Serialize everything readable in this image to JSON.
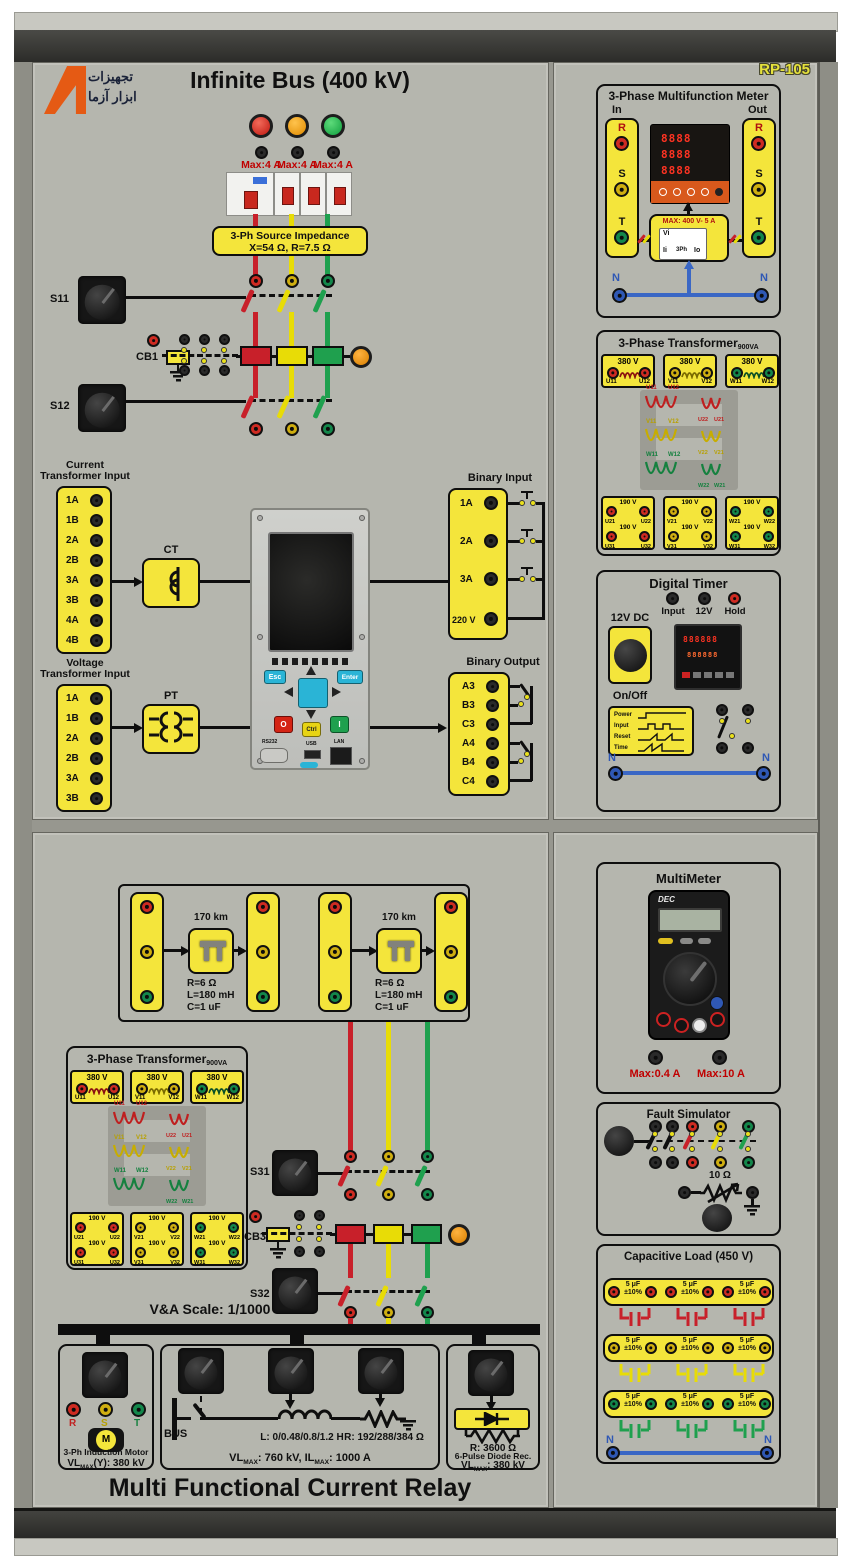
{
  "palette": {
    "panel": "#b5b6ae",
    "yellow": "#f4e53b",
    "phase_red": "#c8202a",
    "phase_yellow": "#e8dc06",
    "phase_green": "#1fa04e",
    "neutral_blue": "#3a67c5",
    "label_red": "#c00000",
    "amber": "#e08b00"
  },
  "brand": {
    "model": "RP-105",
    "logo1": "تجهیزات",
    "logo2": "ابزار آزما"
  },
  "infinite_bus": {
    "title": "Infinite Bus (400 kV)",
    "max_fuse": "Max:4 A",
    "imp1": "3-Ph Source Impedance",
    "imp2": "X=54 Ω, R=7.5 Ω",
    "s11": "S11",
    "cb1": "CB1",
    "s12": "S12"
  },
  "relay_io": {
    "ct_t1": "Current",
    "ct_t2": "Transformer Input",
    "ct_terms": [
      "1A",
      "1B",
      "2A",
      "2B",
      "3A",
      "3B",
      "4A",
      "4B"
    ],
    "ct": "CT",
    "vt_t1": "Voltage",
    "vt_t2": "Transformer Input",
    "vt_terms": [
      "1A",
      "1B",
      "2A",
      "2B",
      "3A",
      "3B"
    ],
    "pt": "PT",
    "bi_title": "Binary Input",
    "bi_terms": [
      "1A",
      "2A",
      "3A",
      "220 V"
    ],
    "bo_title": "Binary Output",
    "bo_terms": [
      "A3",
      "B3",
      "C3",
      "A4",
      "B4",
      "C4"
    ]
  },
  "relay": {
    "esc": "Esc",
    "enter": "Enter",
    "off": "O",
    "ctrl": "Ctrl",
    "on": "I",
    "rs232": "RS232",
    "usb": "USB",
    "lan": "LAN"
  },
  "meter": {
    "title": "3-Phase Multifunction Meter",
    "in": "In",
    "out": "Out",
    "r": "R",
    "s": "S",
    "t": "T",
    "n": "N",
    "display": [
      "8888",
      "8888",
      "8888"
    ],
    "max": "MAX: 400 V- 5 A",
    "vi": "Vi",
    "ii": "Ii",
    "ph": "3Ph",
    "io": "Io"
  },
  "xfmr": {
    "title": "3-Phase Transformer",
    "sub": "900VA",
    "hv_v": "380 V",
    "lv_v": "190 V",
    "hv": [
      [
        "U11",
        "U12"
      ],
      [
        "V11",
        "V12"
      ],
      [
        "W11",
        "W12"
      ]
    ],
    "lv1": [
      [
        "U21",
        "U22"
      ],
      [
        "V21",
        "V22"
      ],
      [
        "W21",
        "W22"
      ]
    ],
    "lv2": [
      [
        "U31",
        "U32"
      ],
      [
        "V31",
        "V32"
      ],
      [
        "W31",
        "W32"
      ]
    ],
    "cr": [
      [
        "U22",
        "U21"
      ],
      [
        "V22",
        "V21"
      ],
      [
        "W22",
        "W21"
      ]
    ]
  },
  "timer": {
    "title": "Digital Timer",
    "j1": "Input",
    "j2": "12V",
    "j3": "Hold",
    "dc": "12V DC",
    "onoff": "On/Off",
    "display": [
      "888888",
      "888888"
    ],
    "d1": "Power",
    "d2": "Input",
    "d3": "Reset",
    "d4": "Time",
    "n": "N"
  },
  "mm": {
    "title": "MultiMeter",
    "brand": "DEC",
    "f1": "Max:0.4 A",
    "f2": "Max:10 A"
  },
  "fault": {
    "title": "Fault Simulator",
    "r": "10 Ω"
  },
  "cap": {
    "title": "Capacitive Load (450 V)",
    "uf": "5 μF",
    "tol": "±10%",
    "n": "N"
  },
  "lines": {
    "km": "170 km",
    "r": "R=6 Ω",
    "l": "L=180 mH",
    "c": "C=1 uF"
  },
  "bl": {
    "s31": "S31",
    "cb3": "CB3",
    "s32": "S32",
    "scale": "V&A Scale: 1/1000",
    "motor": {
      "r": "R",
      "s": "S",
      "t": "T",
      "m": "M",
      "name": "3-Ph Induction Motor",
      "v1": "VL",
      "v2": "MAX",
      "v3": "(Y): 380 kV"
    },
    "load": {
      "bus": "BUS",
      "l": "L: 0/0.48/0.8/1.2 H",
      "r": "R: 192/288/384 Ω",
      "r1": "VL",
      "r2": "MAX",
      "r3": ": 760 kV, IL",
      "r4": "MAX",
      "r5": ": 1000 A"
    },
    "rect": {
      "r": "R: 3600 Ω",
      "name": "6-Pulse Diode Rec.",
      "v1": "VL",
      "v2": "MAX",
      "v3": ": 380 kV"
    },
    "title": "Multi Functional Current Relay"
  }
}
